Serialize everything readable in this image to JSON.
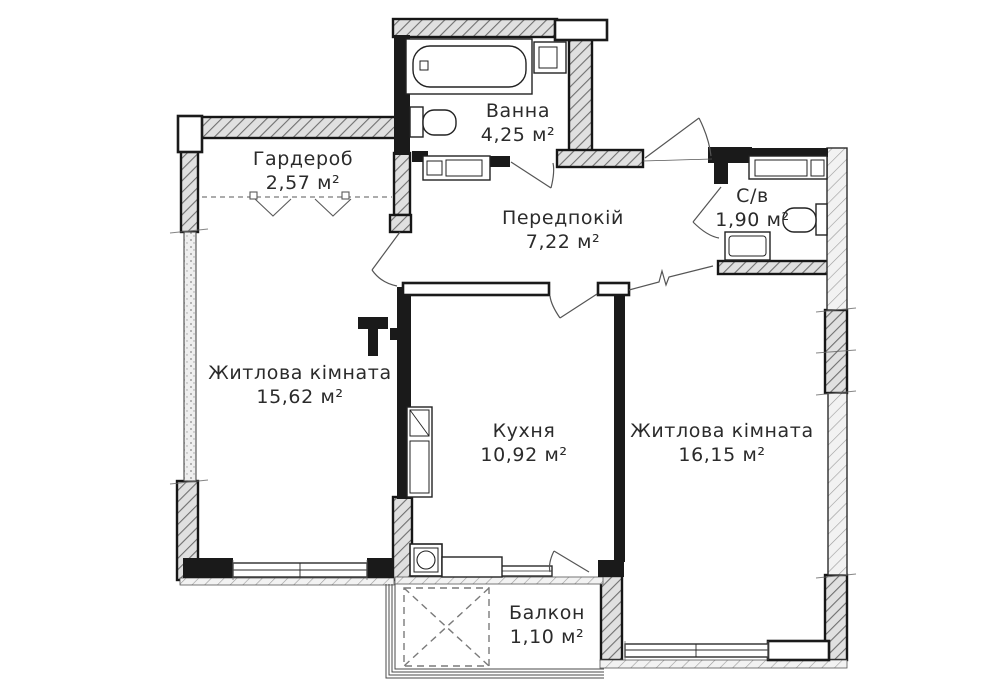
{
  "plan": {
    "title": "2-room apartment floor plan",
    "rooms": [
      {
        "id": "wardrobe",
        "name": "Гардероб",
        "area": "2,57 м²"
      },
      {
        "id": "bathroom",
        "name": "Ванна",
        "area": "4,25 м²"
      },
      {
        "id": "hallway",
        "name": "Передпокій",
        "area": "7,22 м²"
      },
      {
        "id": "wc",
        "name": "С/в",
        "area": "1,90 м²"
      },
      {
        "id": "living1",
        "name": "Житлова кімната",
        "area": "15,62 м²"
      },
      {
        "id": "kitchen",
        "name": "Кухня",
        "area": "10,92 м²"
      },
      {
        "id": "living2",
        "name": "Житлова кімната",
        "area": "16,15 м²"
      },
      {
        "id": "balcony",
        "name": "Балкон",
        "area": "1,10 м²"
      }
    ],
    "fixtures": [
      "bathtub",
      "washing-machine",
      "toilet",
      "sink-counter",
      "shower-tray",
      "fridge-cabinet",
      "stove",
      "kitchen-counter",
      "wardrobe-rail-chevrons",
      "balcony-hatch-cross"
    ],
    "colors": {
      "background": "#ffffff",
      "wall": "#1a1a1a",
      "hatch_fill": "#e3e3e3",
      "hatch_line": "#6f6f6f",
      "thin_line": "#555555"
    }
  }
}
